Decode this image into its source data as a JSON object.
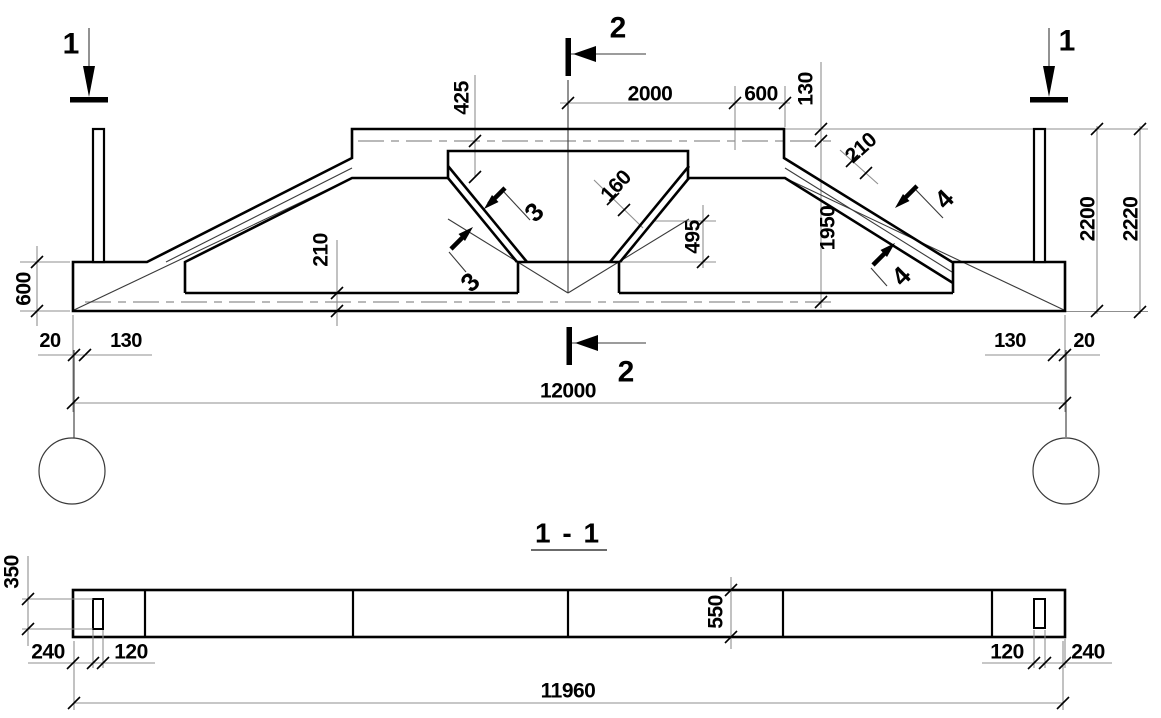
{
  "colors": {
    "ink": "#000000",
    "thin_line": "#3a3a3a",
    "extension_line": "#8f8f8f",
    "background": "#ffffff"
  },
  "elevation": {
    "marker_1_left": "1",
    "marker_1_right": "1",
    "marker_2_top": "2",
    "marker_2_bottom": "2",
    "cut_3_upper": "3",
    "cut_3_lower": "3",
    "cut_4_upper": "4",
    "cut_4_lower": "4",
    "dim_425": "425",
    "dim_2000": "2000",
    "dim_600_top": "600",
    "dim_130_top": "130",
    "dim_210_diagonal": "210",
    "dim_160": "160",
    "dim_495": "495",
    "dim_1950": "1950",
    "dim_2200": "2200",
    "dim_2220": "2220",
    "dim_600_left": "600",
    "dim_210_chord": "210",
    "dim_20_left": "20",
    "dim_130_left": "130",
    "dim_130_right": "130",
    "dim_20_right": "20",
    "dim_12000": "12000"
  },
  "section_view": {
    "title": "1 - 1",
    "dim_350": "350",
    "dim_550": "550",
    "dim_240_left": "240",
    "dim_120_left": "120",
    "dim_120_right": "120",
    "dim_240_right": "240",
    "dim_11960": "11960"
  }
}
